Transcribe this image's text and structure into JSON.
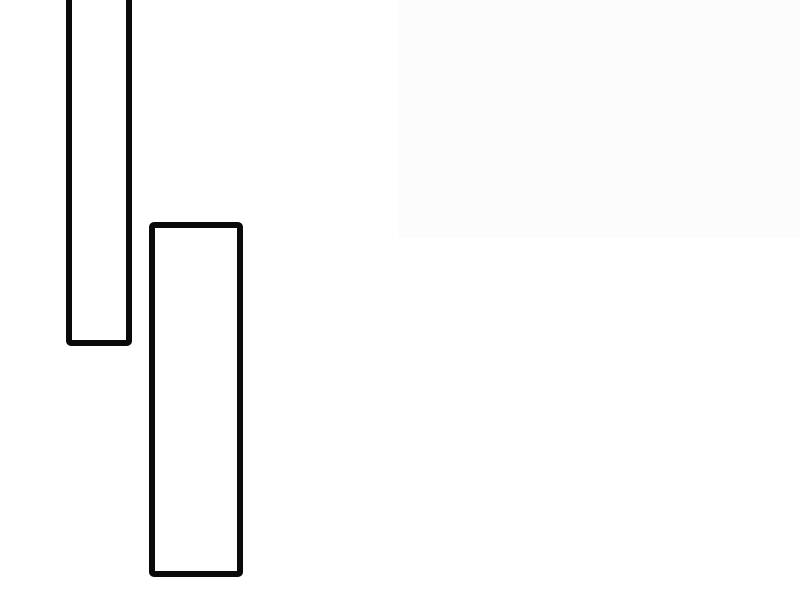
{
  "canvas": {
    "width": 800,
    "height": 600,
    "background_color": "#ffffff"
  },
  "colors": {
    "panel_stroke": "#0a0a0a",
    "panel_fill": "#ffffff",
    "shaded_region_fill": "#fcfcfd"
  },
  "shapes": {
    "shaded_region": {
      "x": 399,
      "y": 0,
      "width": 401,
      "height": 238,
      "fill": "#fcfcfd",
      "stroke": null,
      "stroke_width": 0,
      "corner_radius": 0
    },
    "panel_top": {
      "x": 66,
      "y": -20,
      "width": 66,
      "height": 366,
      "fill": "#ffffff",
      "stroke": "#0a0a0a",
      "stroke_width": 6,
      "corner_radius": 5,
      "note": "clipped by top edge of viewport"
    },
    "panel_bottom": {
      "x": 149,
      "y": 222,
      "width": 94,
      "height": 355,
      "fill": "#ffffff",
      "stroke": "#0a0a0a",
      "stroke_width": 6,
      "corner_radius": 5
    }
  }
}
